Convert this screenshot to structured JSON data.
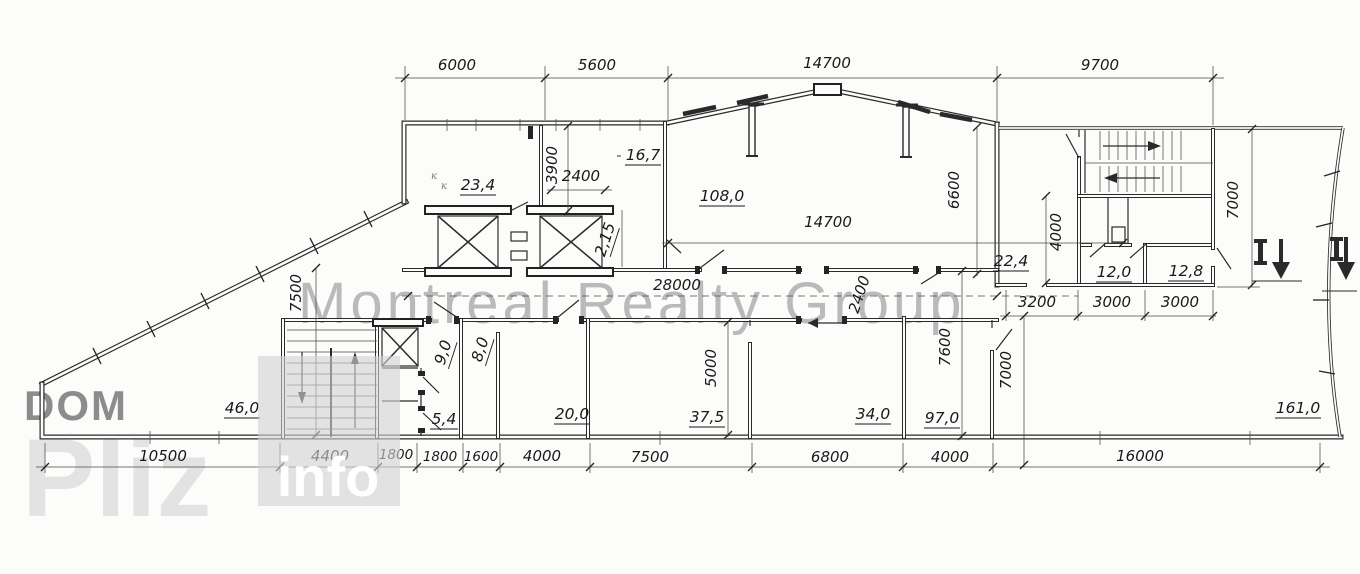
{
  "watermark": {
    "title": "Montreal Realty Group",
    "dom": "DOM",
    "pliz": "Pliz",
    "info": "info",
    "title_color": "#8f8f8f",
    "dom_color": "#8c8c8c",
    "pliz_color": "#e3e3e3",
    "info_box_color": "#d2d2d2",
    "info_text_color": "#ffffff"
  },
  "dims": {
    "top": [
      "6000",
      "5600",
      "14700",
      "9700"
    ],
    "bottom": [
      "10500",
      "4400",
      "1800",
      "1800",
      "1600",
      "4000",
      "7500",
      "6800",
      "4000",
      "16000"
    ],
    "inner": [
      "3900",
      "2400",
      "28000",
      "14700",
      "6600",
      "2400",
      "4000",
      "7000",
      "3200",
      "3000",
      "3000",
      "7500",
      "5000",
      "7600",
      "7000"
    ]
  },
  "rooms": [
    "23,4",
    "16,7",
    "108,0",
    "22,4",
    "12,0",
    "12,8",
    "46,0",
    "5,4",
    "9,0",
    "8,0",
    "2,15",
    "20,0",
    "37,5",
    "34,0",
    "97,0",
    "161,0"
  ],
  "notes": [
    "к",
    "к"
  ]
}
